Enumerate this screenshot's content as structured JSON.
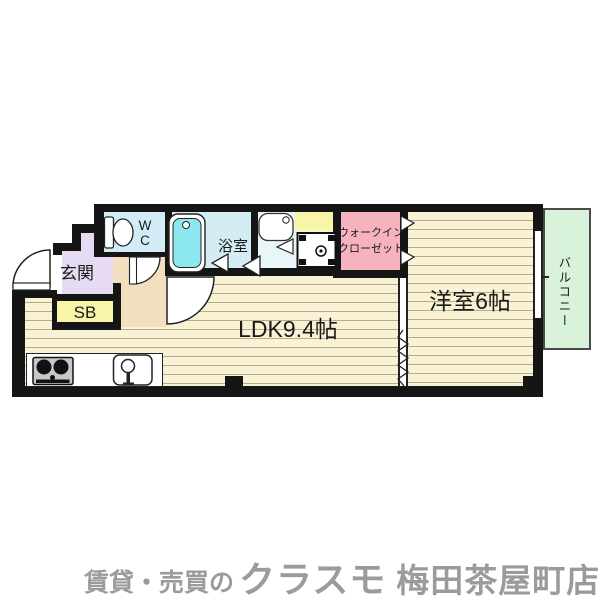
{
  "palette": {
    "wall": "#151515",
    "floor": "#faf2d7",
    "stripe": "#b9ac84",
    "hall": "#f2dfbe",
    "genkan": "#e7daf3",
    "yellow": "#f8f5a8",
    "wc": "#d3edf6",
    "bath": "#d3edf2",
    "wash": "#e9f6f9",
    "tub": "#8ce8ef",
    "closet": "#f6b3bf",
    "balcony": "#d9f3da",
    "graytext": "#9b9b9b"
  },
  "plan": {
    "labels": {
      "genkan": "玄関",
      "shoe_box": "SB",
      "wc": "WC",
      "bathroom": "浴室",
      "walk_in_closet_line1": "ウォークイン",
      "walk_in_closet_line2": "クローゼット",
      "ldk": "LDK9.4帖",
      "western_room": "洋室6帖",
      "balcony": "バルコニー"
    }
  },
  "footer": {
    "prefix": "賃貸・売買の",
    "brand": "クラスモ",
    "store": "梅田茶屋町店"
  }
}
